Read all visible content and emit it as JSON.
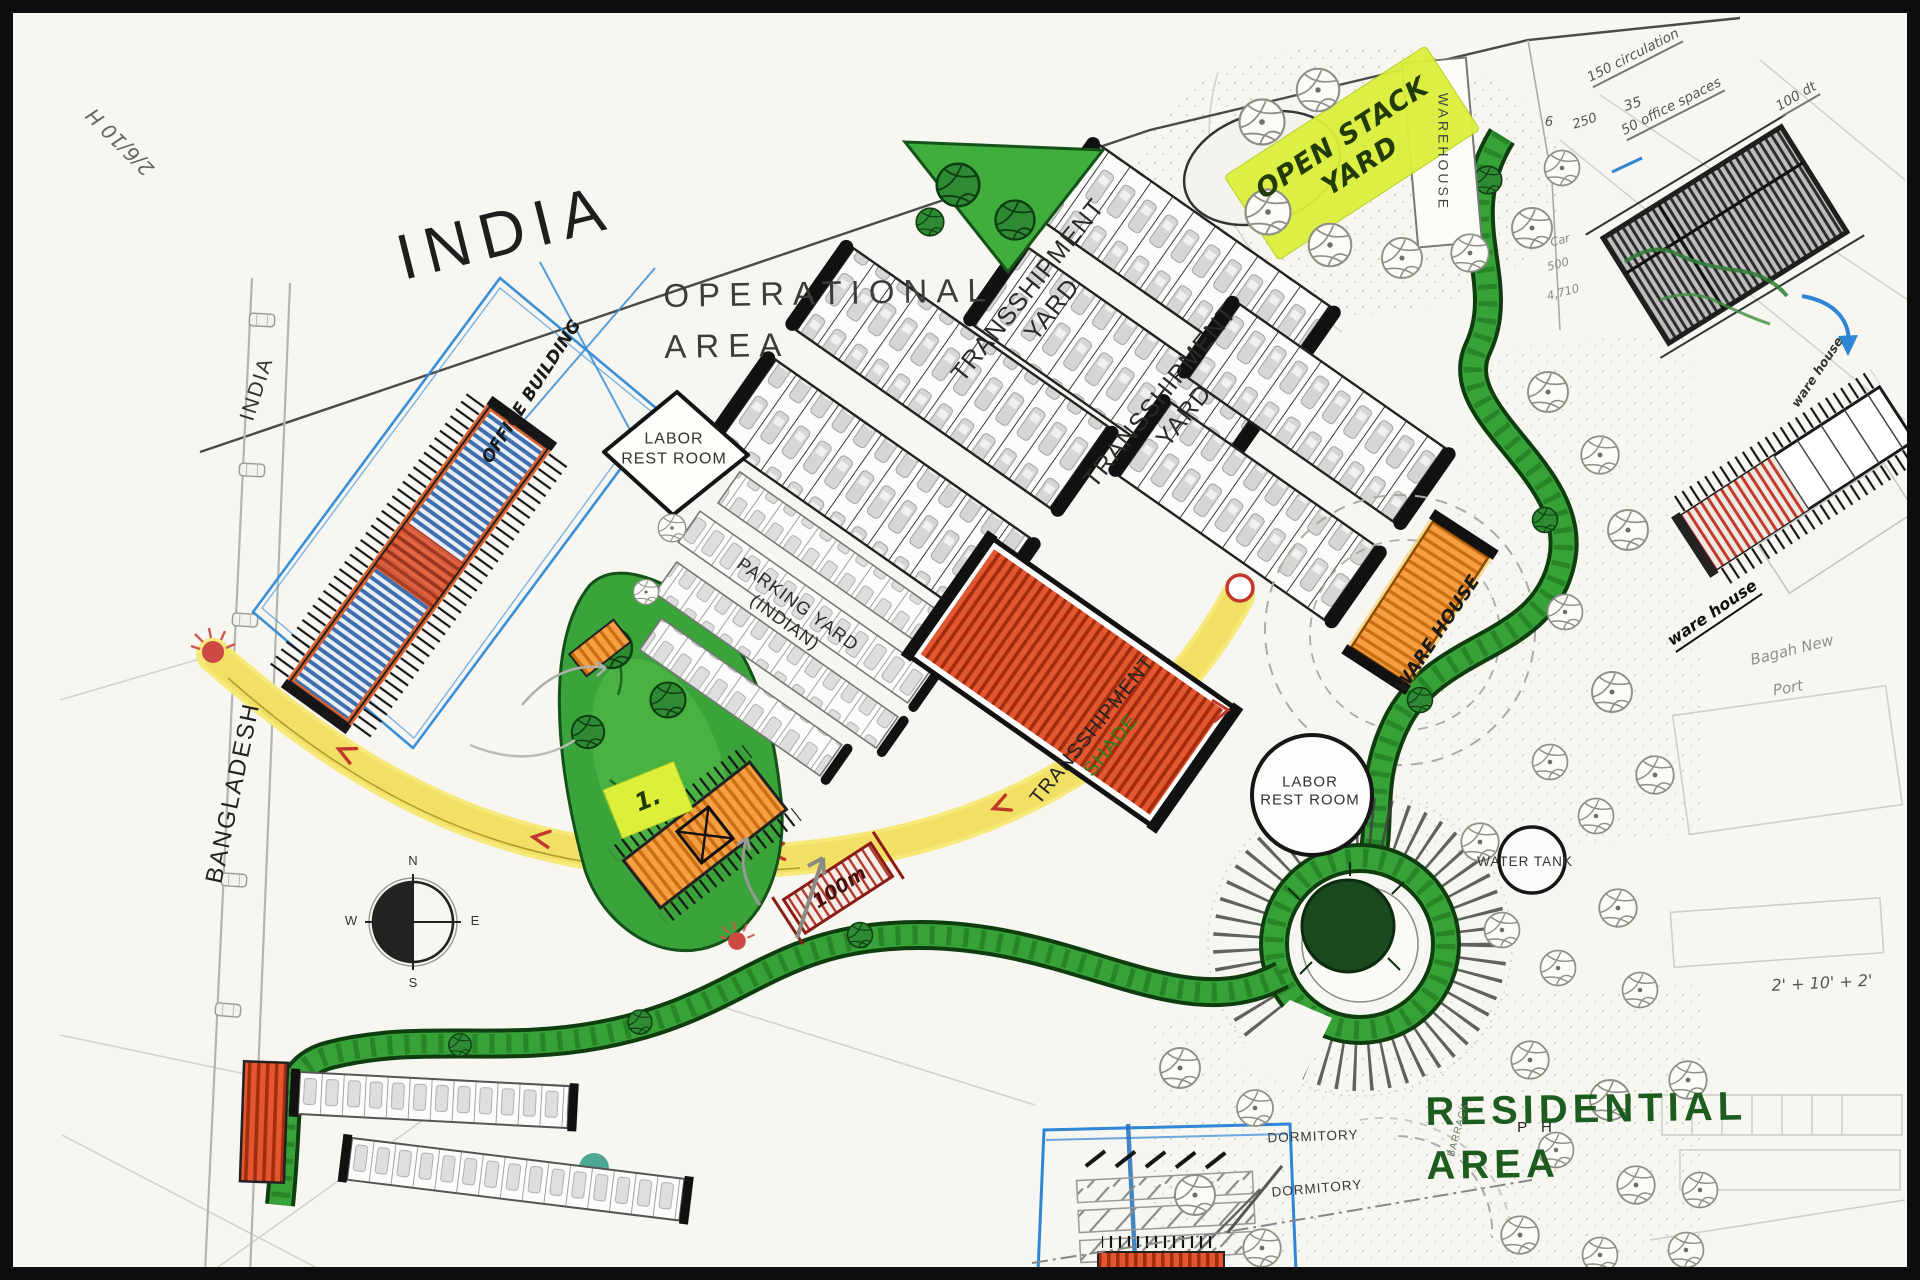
{
  "plan": {
    "india_title": "INDIA",
    "india_road_label": "INDIA",
    "bangladesh_label": "BANGLADESH",
    "operational_area": {
      "line1": "OPERATIONAL",
      "line2": "AREA"
    },
    "residential_area": {
      "line1": "RESIDENTIAL",
      "line2": "AREA"
    },
    "ph_label": "P H",
    "barrack_label": "BARRACK"
  },
  "facilities": {
    "open_stack_yard": {
      "line1": "OPEN STACK",
      "line2": "YARD"
    },
    "warehouse_top": "WAREHOUSE",
    "office_building": "OFFICE BUILDING",
    "labor_rest_room_diamond": {
      "line1": "LABOR",
      "line2": "REST ROOM"
    },
    "transshipment_yard_a": {
      "line1": "TRANSSHIPMENT",
      "line2": "YARD"
    },
    "transshipment_yard_b": {
      "line1": "TRANSSHIPMENT",
      "line2": "YARD"
    },
    "parking_yard_indian": {
      "line1": "PARKING YARD",
      "line2": "(INDIAN)"
    },
    "transshipment_shade": {
      "line1": "TRANSSHIPMENT",
      "line2": "SHADE"
    },
    "ware_house_mid": "WARE HOUSE",
    "labor_rest_room_circle": {
      "line1": "LABOR",
      "line2": "REST ROOM"
    },
    "water_tank": "WATER TANK",
    "dormitory_1": "DORMITORY",
    "dormitory_2": "DORMITORY"
  },
  "handwritten": {
    "corner_mark": "2/6/10 H",
    "note_circulation": "150 circulation",
    "note_office_spaces": "50 office spaces",
    "note_100_dt": "100 dt",
    "note_6": "6",
    "note_250": "250",
    "note_35": "35",
    "note_car": "Car",
    "note_500": "500",
    "note_4710": "4,710",
    "sticker_number": "1.",
    "dim_100m": "100m",
    "ware_house_sketch_label": "ware house",
    "ware_house_sketch_label_2": "ware house",
    "new_port_line1": "Bagah New",
    "new_port_line2": "Port",
    "dim_setback": "2' + 10' + 2'"
  },
  "compass": {
    "n": "N",
    "e": "E",
    "s": "S",
    "w": "W"
  },
  "colors": {
    "road_yellow": "#f7e87a",
    "greenway": "#36a237",
    "shade_red": "#e2572f",
    "warehouse_orange": "#f59f42",
    "sticker_yellow": "#dbef3b",
    "sketch_blue": "#3b8fd6",
    "residential_green": "#1d5c1f",
    "arrow_red": "#c0392b"
  }
}
